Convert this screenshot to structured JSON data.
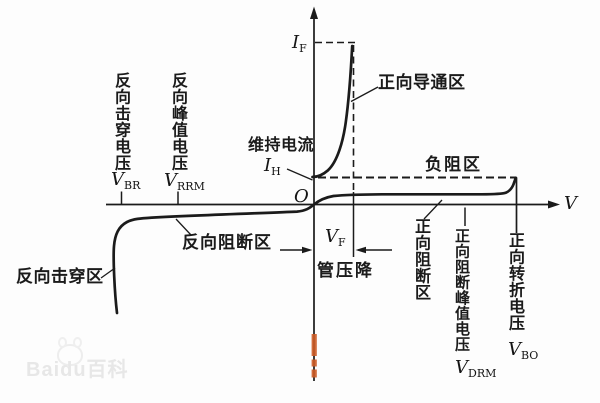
{
  "axis": {
    "x_label": "V",
    "origin": "O",
    "i_f": {
      "main": "I",
      "sub": "F"
    },
    "i_h": {
      "main": "I",
      "sub": "H"
    }
  },
  "regions": {
    "forward_conduction": "正向导通区",
    "negative_resistance": "负阻区",
    "forward_blocking": "正向阻断区",
    "reverse_blocking": "反向阻断区",
    "reverse_breakdown": "反向击穿区"
  },
  "annotations": {
    "holding_current": "维持电流",
    "tube_voltage_drop": "管压降",
    "v_f": {
      "main": "V",
      "sub": "F"
    }
  },
  "voltages": {
    "v_br": {
      "text": "反向击穿电压",
      "main": "V",
      "sub": "BR"
    },
    "v_rrm": {
      "text": "反向峰值电压",
      "main": "V",
      "sub": "RRM"
    },
    "v_drm": {
      "text": "正向阻断峰值电压",
      "main": "V",
      "sub": "DRM"
    },
    "v_bo": {
      "text": "正向转折电压",
      "main": "V",
      "sub": "BO"
    }
  },
  "watermark": "Baidu百科",
  "colors": {
    "ink": "#1b1b1b",
    "orange_mark": "#cc5c26",
    "watermark_gray": "#e7e7e7",
    "background": "#fdfdfd"
  }
}
